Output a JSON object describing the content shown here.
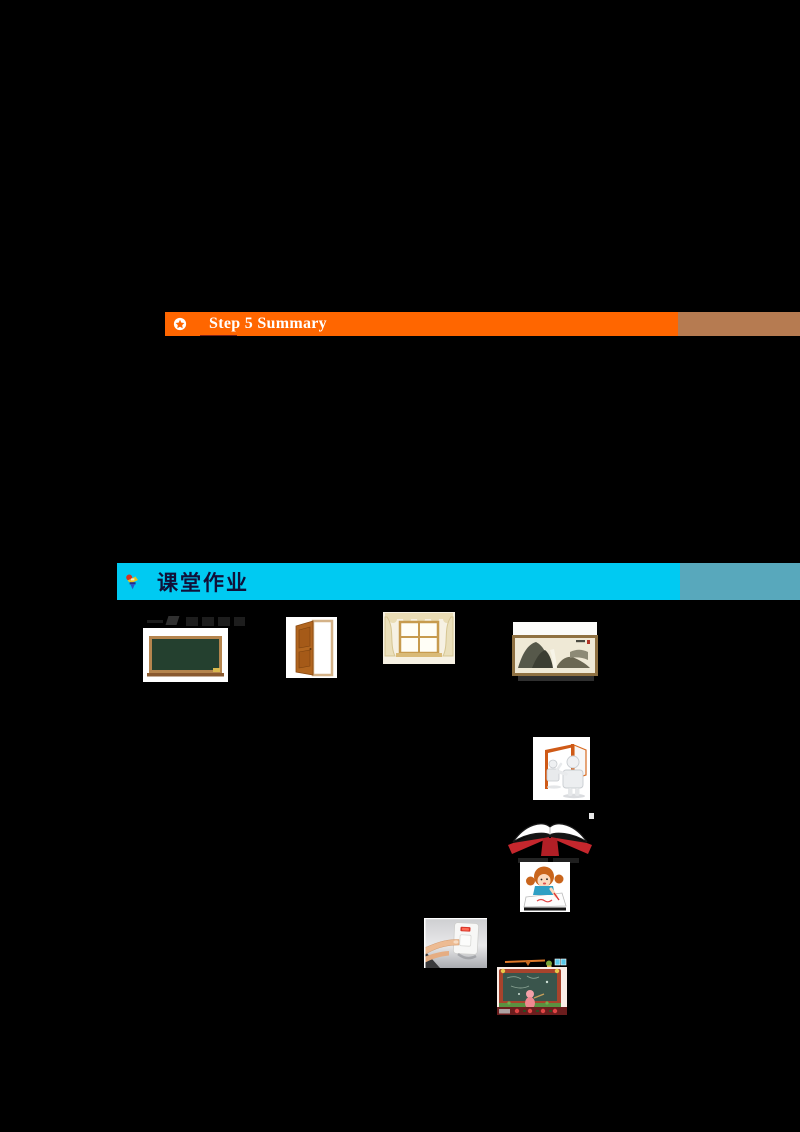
{
  "summary_banner": {
    "label": "Step 5 Summary",
    "bar_color": "#FF6600",
    "end_block_color": "#B67B51",
    "text_color": "#FFFFFF",
    "icon": "star-in-circle"
  },
  "homework_banner": {
    "label": "课堂作业",
    "bar_color": "#00CAF2",
    "end_block_color": "#58A8BC",
    "text_color": "#101038",
    "icon": "pushpin"
  },
  "images": {
    "blackboard": "blackboard-photo",
    "door": "open-door-photo",
    "window": "curtained-window-photo",
    "painting": "framed-landscape-painting-photo",
    "door_figures": "figures-at-open-door-clipart",
    "open_book": "open-red-book-clipart",
    "girl_writing": "girl-writing-clipart",
    "light_switch": "finger-pressing-light-switch-photo",
    "classroom_board": "cartoon-classroom-blackboard"
  },
  "page": {
    "background": "#000000"
  }
}
